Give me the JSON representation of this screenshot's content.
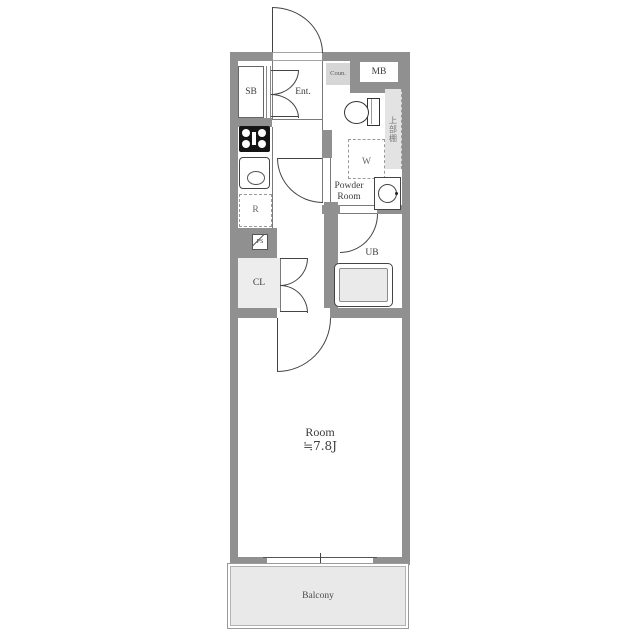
{
  "floorplan": {
    "labels": {
      "shoe_box": "SB",
      "entrance": "Ent.",
      "counter": "Coun.",
      "meter_box": "MB",
      "upper_shelf": "上部棚",
      "washer_space": "W",
      "powder_room_line1": "Powder",
      "powder_room_line2": "Room",
      "refrigerator_space": "R",
      "pipe_space": "PS",
      "closet": "CL",
      "unit_bath": "UB",
      "main_room_name": "Room",
      "main_room_size": "≒7.8J",
      "balcony": "Balcony"
    },
    "fixtures": [
      "entrance-door",
      "shoe-box-doors",
      "gas-stove",
      "kitchen-sink",
      "refrigerator-space",
      "pipe-space",
      "closet-doors",
      "toilet",
      "washing-machine-space",
      "washbasin",
      "bathtub",
      "hallway-door",
      "bathroom-door",
      "room-door",
      "sliding-window"
    ],
    "colors": {
      "wall": "#909090",
      "line": "#444444",
      "balcony_fill": "#e9e9e9",
      "closet_fill": "#ededed",
      "counter_fill": "#d6d6d6",
      "shelf_fill": "#e3e3e3",
      "text": "#3b3b3b"
    }
  }
}
